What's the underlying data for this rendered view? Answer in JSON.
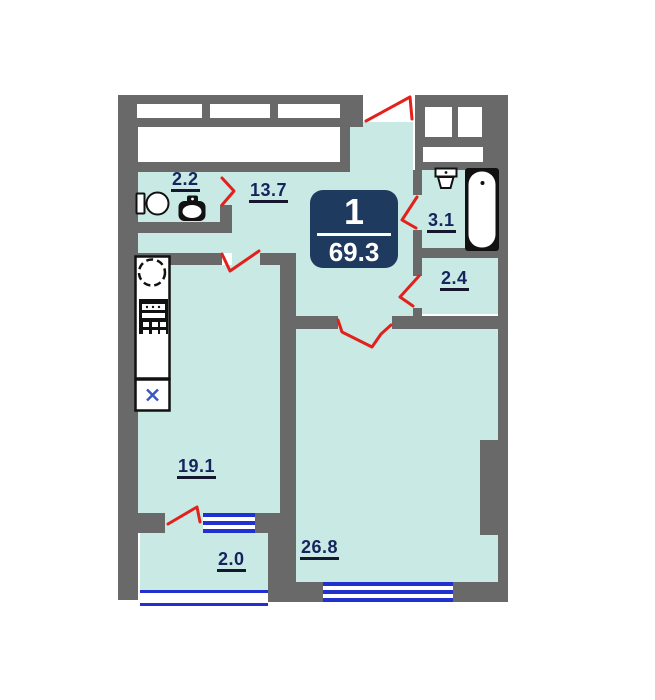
{
  "floorplan": {
    "badge": {
      "room_count": "1",
      "total_area": "69.3"
    },
    "rooms": [
      {
        "key": "toilet",
        "area": "2.2"
      },
      {
        "key": "hallway",
        "area": "13.7"
      },
      {
        "key": "bathroom",
        "area": "3.1"
      },
      {
        "key": "storage",
        "area": "2.4"
      },
      {
        "key": "kitchen",
        "area": "19.1"
      },
      {
        "key": "living_room",
        "area": "26.8"
      },
      {
        "key": "balcony",
        "area": "2.0"
      }
    ],
    "colors": {
      "room_fill": "#c9e9e5",
      "wall": "#696969",
      "window_blue": "#2031d0",
      "door_red": "#e3211c",
      "badge_bg": "#1e3a5f",
      "badge_text": "#ffffff",
      "label_text": "#16245d"
    }
  }
}
